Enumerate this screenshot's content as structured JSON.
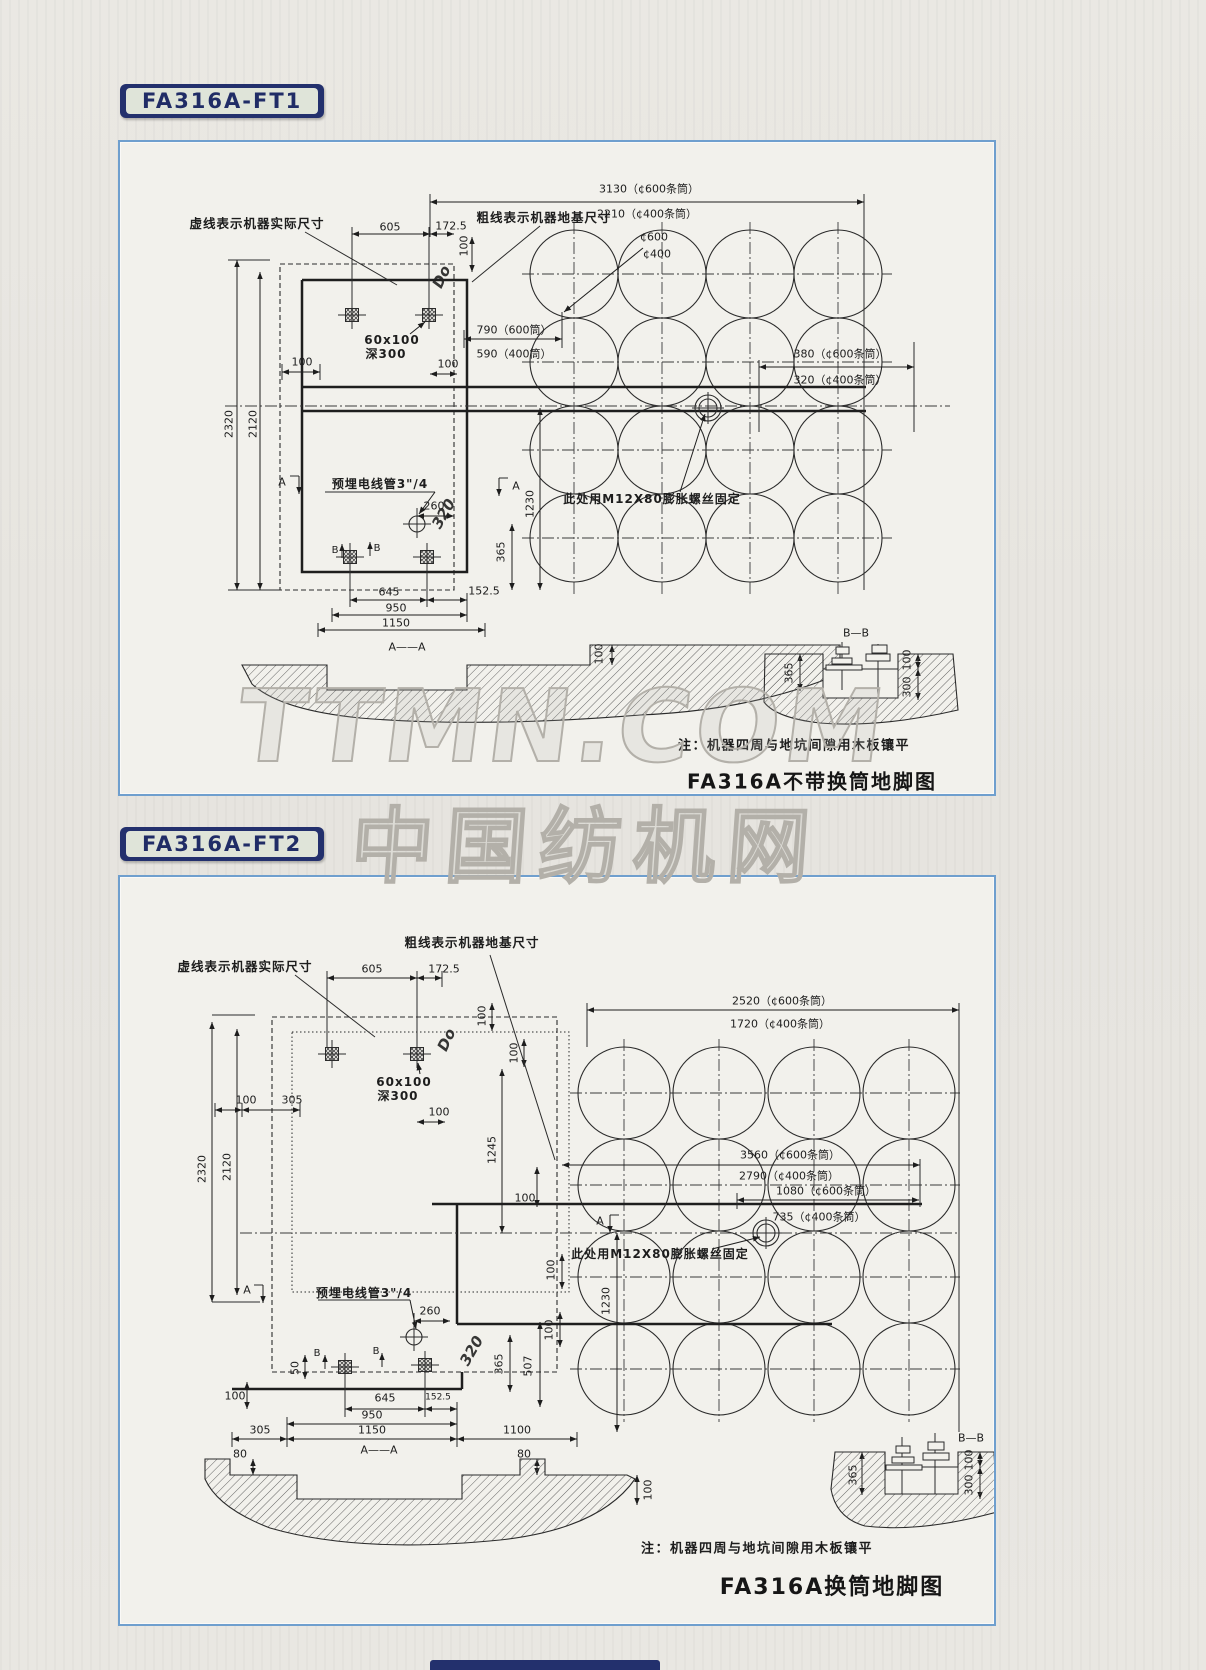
{
  "page": {
    "watermark_primary": "TTMN.COM",
    "watermark_secondary": "中国纺机网",
    "colors": {
      "chip_navy": "#23306d",
      "panel_border": "#6f9fce",
      "paper": "#e7e5e0"
    }
  },
  "ft1": {
    "tag": "FA316A-FT1",
    "title": "FA316A不带换筒地脚图",
    "note": "注：机器四周与地坑间隙用木板镶平",
    "labels": [
      {
        "name": "label-dashed-machine-size",
        "text": "虚线表示机器实际尺寸",
        "x": 137,
        "y": 82,
        "cls": "cn"
      },
      {
        "name": "dim-605",
        "text": "605",
        "x": 270,
        "y": 85
      },
      {
        "name": "dim-172-5",
        "text": "172.5",
        "x": 331,
        "y": 84
      },
      {
        "name": "label-thick-foundation-size",
        "text": "粗线表示机器地基尺寸",
        "x": 424,
        "y": 76,
        "cls": "cn"
      },
      {
        "name": "dim-3130",
        "text": "3130（¢600条筒）",
        "x": 529,
        "y": 47
      },
      {
        "name": "dim-2210",
        "text": "2210（¢400条筒）",
        "x": 527,
        "y": 72
      },
      {
        "name": "dim-100-top",
        "text": "100",
        "x": 344,
        "y": 104,
        "rot": -90
      },
      {
        "name": "label-c600",
        "text": "¢600",
        "x": 534,
        "y": 95
      },
      {
        "name": "label-c400",
        "text": "¢400",
        "x": 537,
        "y": 112
      },
      {
        "name": "dim-790",
        "text": "790（600筒）",
        "x": 394,
        "y": 188
      },
      {
        "name": "dim-590",
        "text": "590（400筒）",
        "x": 394,
        "y": 212
      },
      {
        "name": "dim-100-mid",
        "text": "100",
        "x": 328,
        "y": 222
      },
      {
        "name": "dim-100-left",
        "text": "100",
        "x": 182,
        "y": 220
      },
      {
        "name": "dim-380",
        "text": "380（¢600条筒）",
        "x": 720,
        "y": 212
      },
      {
        "name": "dim-320",
        "text": "320（¢400条筒）",
        "x": 720,
        "y": 238
      },
      {
        "name": "label-anchor-bolt",
        "text": "此处用M12X80膨胀螺丝固定",
        "x": 532,
        "y": 357,
        "cls": "cn",
        "size": 12
      },
      {
        "name": "dim-2320",
        "text": "2320",
        "x": 109,
        "y": 282,
        "rot": -90
      },
      {
        "name": "dim-2120",
        "text": "2120",
        "x": 133,
        "y": 282,
        "rot": -90
      },
      {
        "name": "section-a-left",
        "text": "A",
        "x": 162,
        "y": 340
      },
      {
        "name": "label-conduit",
        "text": "预埋电线管3\"/4",
        "x": 260,
        "y": 342,
        "cls": "cn",
        "size": 12
      },
      {
        "name": "section-a-right",
        "text": "A",
        "x": 396,
        "y": 344
      },
      {
        "name": "dim-260",
        "text": "260",
        "x": 314,
        "y": 364
      },
      {
        "name": "dim-1230",
        "text": "1230",
        "x": 410,
        "y": 362,
        "rot": -90
      },
      {
        "name": "dim-365",
        "text": "365",
        "x": 381,
        "y": 410,
        "rot": -90
      },
      {
        "name": "marker-b-left",
        "text": "B",
        "x": 215,
        "y": 409,
        "size": 10
      },
      {
        "name": "marker-b-right",
        "text": "B",
        "x": 257,
        "y": 407,
        "size": 10
      },
      {
        "name": "bolt-note-60x100",
        "text": "60x100",
        "x": 272,
        "y": 198,
        "cls": "cn",
        "size": 12
      },
      {
        "name": "bolt-note-deep300",
        "text": "深300",
        "x": 266,
        "y": 212,
        "cls": "cn",
        "size": 12
      },
      {
        "name": "dim-645",
        "text": "645",
        "x": 269,
        "y": 450
      },
      {
        "name": "dim-152-5",
        "text": "152.5",
        "x": 364,
        "y": 449
      },
      {
        "name": "dim-950",
        "text": "950",
        "x": 276,
        "y": 466
      },
      {
        "name": "dim-1150",
        "text": "1150",
        "x": 276,
        "y": 481
      },
      {
        "name": "section-aa-title",
        "text": "A——A",
        "x": 287,
        "y": 505
      },
      {
        "name": "dim-100-section",
        "text": "100",
        "x": 479,
        "y": 512,
        "rot": -90
      },
      {
        "name": "section-bb-title",
        "text": "B—B",
        "x": 736,
        "y": 491
      },
      {
        "name": "dim-365-bb",
        "text": "365",
        "x": 669,
        "y": 531,
        "rot": -90
      },
      {
        "name": "dim-100-bb",
        "text": "100",
        "x": 787,
        "y": 518,
        "rot": -90
      },
      {
        "name": "dim-300-bb",
        "text": "300",
        "x": 787,
        "y": 545,
        "rot": -90
      },
      {
        "name": "scribble-top",
        "text": "Do",
        "x": 322,
        "y": 135,
        "rot": -65,
        "cls": "scr"
      },
      {
        "name": "scribble-bottom",
        "text": "320",
        "x": 324,
        "y": 372,
        "rot": -60,
        "cls": "scr"
      }
    ]
  },
  "ft2": {
    "tag": "FA316A-FT2",
    "title": "FA316A换筒地脚图",
    "note": "注：机器四周与地坑间隙用木板镶平",
    "labels": [
      {
        "name": "label-thick-foundation-size",
        "text": "粗线表示机器地基尺寸",
        "x": 352,
        "y": 66,
        "cls": "cn"
      },
      {
        "name": "dim-2520",
        "text": "2520（¢600条筒）",
        "x": 662,
        "y": 124
      },
      {
        "name": "dim-1720",
        "text": "1720（¢400条筒）",
        "x": 660,
        "y": 147
      },
      {
        "name": "label-dashed-machine-size",
        "text": "虚线表示机器实际尺寸",
        "x": 125,
        "y": 90,
        "cls": "cn"
      },
      {
        "name": "dim-605",
        "text": "605",
        "x": 252,
        "y": 92
      },
      {
        "name": "dim-172-5",
        "text": "172.5",
        "x": 324,
        "y": 92
      },
      {
        "name": "dim-100-a",
        "text": "100",
        "x": 362,
        "y": 139,
        "rot": -90
      },
      {
        "name": "dim-100-b",
        "text": "100",
        "x": 394,
        "y": 176,
        "rot": -90
      },
      {
        "name": "bolt-note-60x100",
        "text": "60x100",
        "x": 284,
        "y": 205,
        "cls": "cn",
        "size": 12
      },
      {
        "name": "bolt-note-deep300",
        "text": "深300",
        "x": 278,
        "y": 219,
        "cls": "cn",
        "size": 12
      },
      {
        "name": "dim-100-left",
        "text": "100",
        "x": 126,
        "y": 223
      },
      {
        "name": "dim-305-left",
        "text": "305",
        "x": 172,
        "y": 223
      },
      {
        "name": "dim-100-c",
        "text": "100",
        "x": 319,
        "y": 235
      },
      {
        "name": "dim-1245",
        "text": "1245",
        "x": 372,
        "y": 273,
        "rot": -90
      },
      {
        "name": "dim-3560",
        "text": "3560（¢600条筒）",
        "x": 670,
        "y": 278
      },
      {
        "name": "dim-2790",
        "text": "2790（¢400条筒）",
        "x": 669,
        "y": 299
      },
      {
        "name": "dim-1080",
        "text": "1080（¢600条筒）",
        "x": 706,
        "y": 314
      },
      {
        "name": "dim-735",
        "text": "735（¢400条筒）",
        "x": 699,
        "y": 340
      },
      {
        "name": "dim-2320",
        "text": "2320",
        "x": 82,
        "y": 292,
        "rot": -90
      },
      {
        "name": "dim-2120",
        "text": "2120",
        "x": 107,
        "y": 290,
        "rot": -90
      },
      {
        "name": "dim-100-d",
        "text": "100",
        "x": 405,
        "y": 321
      },
      {
        "name": "section-a-right",
        "text": "A",
        "x": 480,
        "y": 344
      },
      {
        "name": "label-anchor-bolt",
        "text": "此处用M12X80膨胀螺丝固定",
        "x": 540,
        "y": 377,
        "cls": "cn",
        "size": 12
      },
      {
        "name": "section-a-left",
        "text": "A",
        "x": 127,
        "y": 413
      },
      {
        "name": "label-conduit",
        "text": "预埋电线管3\"/4",
        "x": 244,
        "y": 416,
        "cls": "cn",
        "size": 12
      },
      {
        "name": "dim-260",
        "text": "260",
        "x": 310,
        "y": 434
      },
      {
        "name": "dim-50",
        "text": "50",
        "x": 175,
        "y": 491,
        "rot": -90
      },
      {
        "name": "marker-b-left",
        "text": "B",
        "x": 197,
        "y": 477,
        "size": 10
      },
      {
        "name": "marker-b-right",
        "text": "B",
        "x": 256,
        "y": 475,
        "size": 10
      },
      {
        "name": "scribble-mid",
        "text": "320",
        "x": 352,
        "y": 474,
        "rot": -60,
        "cls": "scr"
      },
      {
        "name": "dim-365",
        "text": "365",
        "x": 379,
        "y": 487,
        "rot": -90
      },
      {
        "name": "dim-507",
        "text": "507",
        "x": 408,
        "y": 489,
        "rot": -90
      },
      {
        "name": "dim-100-e",
        "text": "100",
        "x": 429,
        "y": 453,
        "rot": -90
      },
      {
        "name": "dim-1230",
        "text": "1230",
        "x": 486,
        "y": 424,
        "rot": -90
      },
      {
        "name": "dim-100-f",
        "text": "100",
        "x": 431,
        "y": 393,
        "rot": -90
      },
      {
        "name": "dim-100-g",
        "text": "100",
        "x": 115,
        "y": 519
      },
      {
        "name": "dim-645",
        "text": "645",
        "x": 265,
        "y": 521
      },
      {
        "name": "dim-152-5",
        "text": "152.5",
        "x": 318,
        "y": 521,
        "size": 9
      },
      {
        "name": "dim-950",
        "text": "950",
        "x": 252,
        "y": 538
      },
      {
        "name": "dim-305-bottom",
        "text": "305",
        "x": 140,
        "y": 553
      },
      {
        "name": "dim-1150",
        "text": "1150",
        "x": 252,
        "y": 553
      },
      {
        "name": "dim-1100",
        "text": "1100",
        "x": 397,
        "y": 553
      },
      {
        "name": "section-aa-title",
        "text": "A——A",
        "x": 259,
        "y": 573
      },
      {
        "name": "dim-80-left",
        "text": "80",
        "x": 120,
        "y": 577
      },
      {
        "name": "dim-80-right",
        "text": "80",
        "x": 404,
        "y": 577
      },
      {
        "name": "dim-100-section",
        "text": "100",
        "x": 528,
        "y": 613,
        "rot": -90
      },
      {
        "name": "section-bb-title",
        "text": "B—B",
        "x": 851,
        "y": 561
      },
      {
        "name": "dim-365-bb",
        "text": "365",
        "x": 733,
        "y": 598,
        "rot": -90
      },
      {
        "name": "dim-100-bb",
        "text": "100",
        "x": 849,
        "y": 583,
        "rot": -90
      },
      {
        "name": "dim-300-bb",
        "text": "300",
        "x": 849,
        "y": 608,
        "rot": -90
      },
      {
        "name": "scribble-top",
        "text": "Do",
        "x": 327,
        "y": 163,
        "rot": -65,
        "cls": "scr"
      }
    ]
  }
}
